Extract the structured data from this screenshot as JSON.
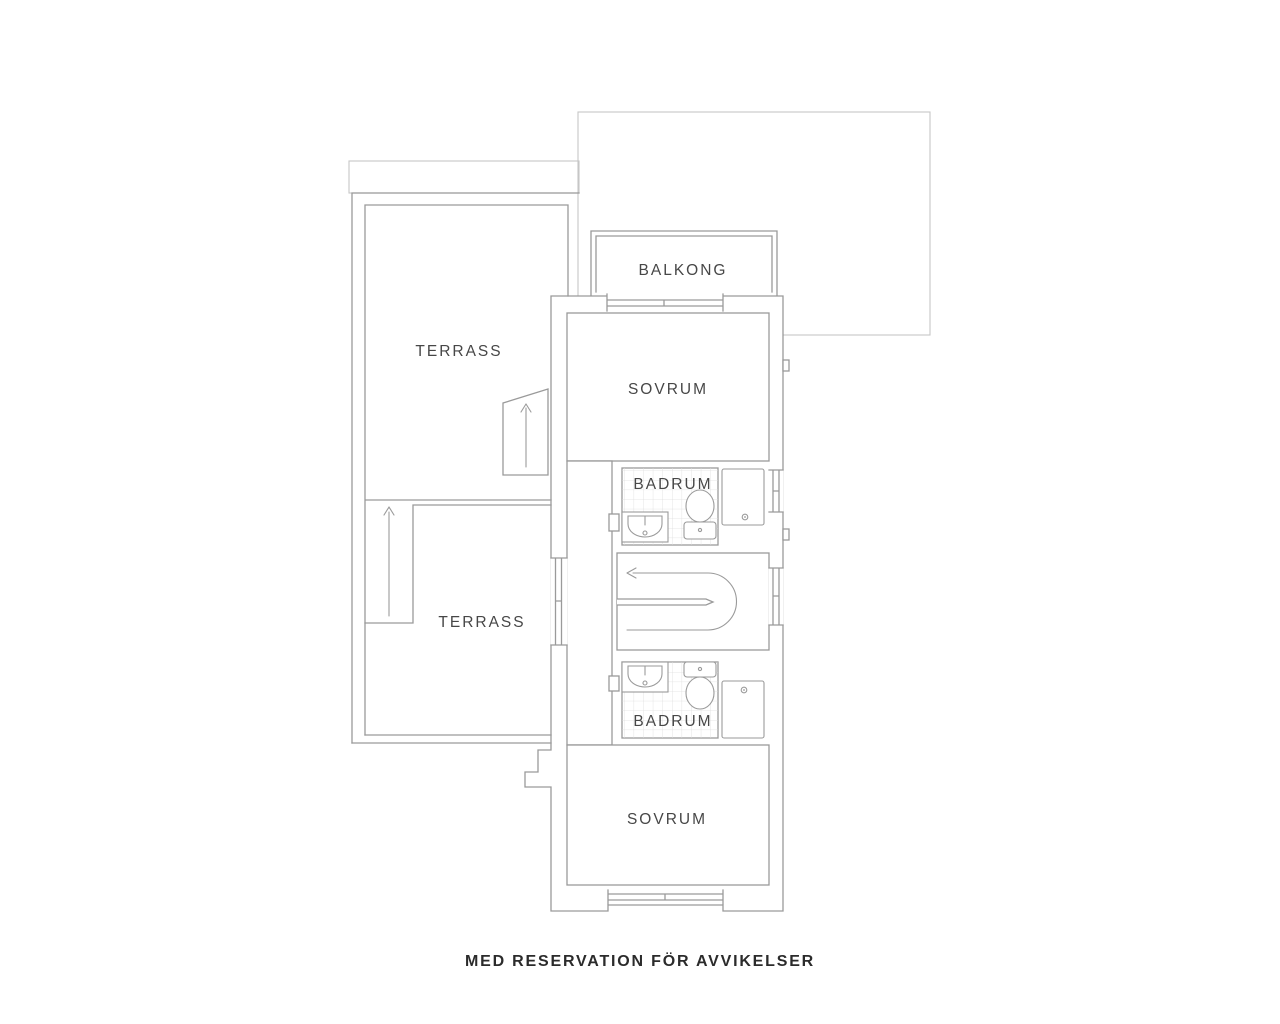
{
  "page": {
    "type": "floor-plan"
  },
  "colors": {
    "wall": "#9a9a9a",
    "roof-line": "#c6c6c6",
    "tile-line": "#dedede",
    "label": "#474747",
    "footer-text": "#2b2b2b",
    "fixture": "#9a9a9a",
    "bg": "#ffffff"
  },
  "plan": {
    "rooms": {
      "terrace_upper": {
        "label": "TERRASS"
      },
      "balcony": {
        "label": "BALKONG"
      },
      "bedroom_upper": {
        "label": "SOVRUM"
      },
      "bathroom_upper": {
        "label": "BADRUM"
      },
      "terrace_lower": {
        "label": "TERRASS"
      },
      "bathroom_lower": {
        "label": "BADRUM"
      },
      "bedroom_lower": {
        "label": "SOVRUM"
      }
    },
    "fixtures": [
      "sink-icon",
      "toilet-icon",
      "shower-icon",
      "stair-direction-arrow-icon",
      "stairs-up-arrow-icon",
      "window",
      "balcony-door"
    ],
    "disclaimer": "MED RESERVATION FÖR AVVIKELSER"
  }
}
